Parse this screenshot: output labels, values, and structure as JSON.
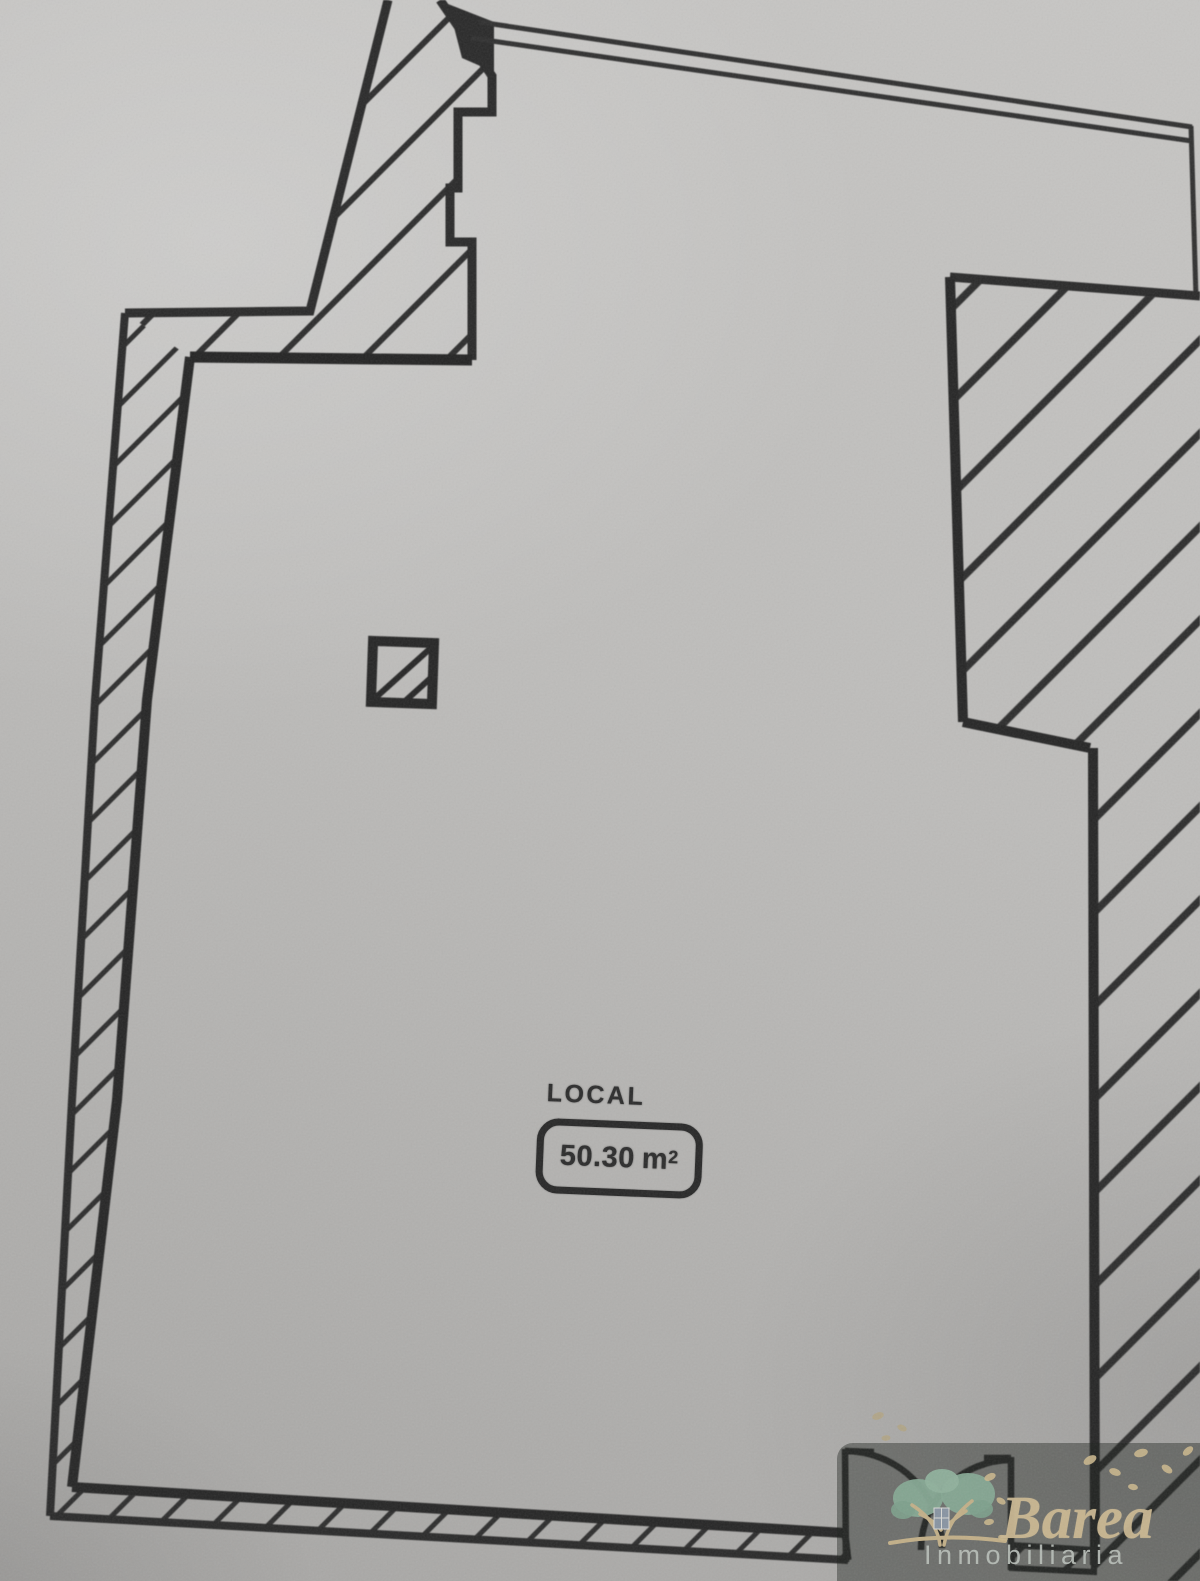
{
  "room_label": {
    "name": "LOCAL",
    "area_value": "50.30",
    "area_unit": "m",
    "area_exponent": "2"
  },
  "watermark": {
    "brand": "Barea",
    "subtitle": "Inmobiliaria"
  },
  "colors": {
    "paper": "#bdbcba",
    "ink": "#2b2b2b",
    "watermark_band": "rgba(27,30,27,0.42)",
    "brand_gold": "#cbb892",
    "subtitle_gray": "#b9bfb9",
    "foliage_green": "#86a894",
    "branch_tan": "#c2af88"
  },
  "icons": {
    "logo": "tree-logo"
  }
}
